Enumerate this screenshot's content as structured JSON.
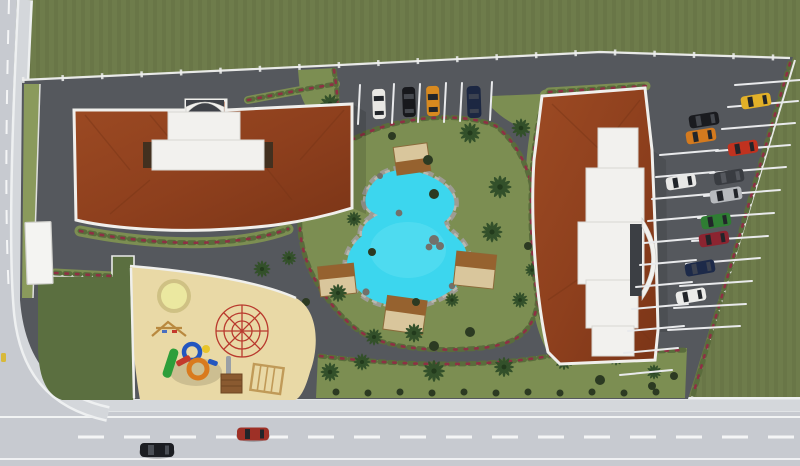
{
  "scene": {
    "name": "residential-complex-site-plan",
    "view": "top-down-3d-render",
    "amenities": [
      "lagoon-pool",
      "playground",
      "pergolas",
      "palm-garden",
      "parking"
    ]
  },
  "colors": {
    "grass": "#6e7c4b",
    "grass_dark": "#5b6f40",
    "garden": "#7c8e52",
    "garden_light": "#8a9a5c",
    "asphalt": "#55585d",
    "asphalt_dark": "#4c4f54",
    "road": "#c7cad0",
    "sidewalk": "#d4d7db",
    "marking": "#f4f5f6",
    "roof": "#94431f",
    "roof_dark": "#773517",
    "building_white": "#f2f1ee",
    "pool_water": "#3cd6ee",
    "rock": "#9d9c94",
    "rock_dark": "#72716b",
    "sand": "#e9d9a6",
    "pergola_base": "#d9c69c",
    "pergola_roof": "#96622f",
    "palm": "#33502a",
    "shrub": "#2c3a22",
    "hedge": "#5a6c3c",
    "flower": "#8e3044",
    "trampoline": "#ebe8a0",
    "trampoline_ring": "#cfc184",
    "dome": "#b93a2e",
    "window": "#22252a",
    "booth": "#f4f4f2",
    "hydrant": "#d8b93a"
  },
  "site": {
    "buildings": [
      {
        "id": "west-building",
        "roof": "terracotta",
        "entrance": "north-arch-canopy"
      },
      {
        "id": "east-building",
        "roof": "terracotta",
        "entrance": "east-arch-canopy"
      }
    ],
    "pergola_count": 4,
    "palm_count": 22,
    "playground_items": [
      "trampoline",
      "swing-frame",
      "climbing-dome",
      "play-structure",
      "post-crate",
      "wooden-frame"
    ]
  },
  "parking": {
    "north_row": {
      "cars": [
        {
          "name": "white-car",
          "color": "#e9e8e4"
        },
        {
          "name": "black-car",
          "color": "#17181c"
        },
        {
          "name": "orange-convertible",
          "color": "#d98a1f"
        },
        {
          "name": "navy-car",
          "color": "#1c2742"
        }
      ]
    },
    "east_lot": {
      "cars": [
        {
          "name": "yellow-car",
          "color": "#e2b028"
        },
        {
          "name": "black-car",
          "color": "#1a1b1f"
        },
        {
          "name": "orange-car",
          "color": "#d47a1e"
        },
        {
          "name": "red-car",
          "color": "#c0321f"
        },
        {
          "name": "dark-gray-suv",
          "color": "#393c41"
        },
        {
          "name": "white-car",
          "color": "#e8e8e6"
        },
        {
          "name": "silver-van",
          "color": "#b7babe"
        },
        {
          "name": "green-car",
          "color": "#2f7d33"
        },
        {
          "name": "dark-red-car",
          "color": "#8c2430"
        },
        {
          "name": "navy-car",
          "color": "#1d2a49"
        },
        {
          "name": "white-car-2",
          "color": "#ececea"
        }
      ]
    }
  },
  "street": {
    "cars": [
      {
        "name": "black-sedan",
        "color": "#1b1d22"
      },
      {
        "name": "red-sedan",
        "color": "#9e3026"
      }
    ]
  }
}
